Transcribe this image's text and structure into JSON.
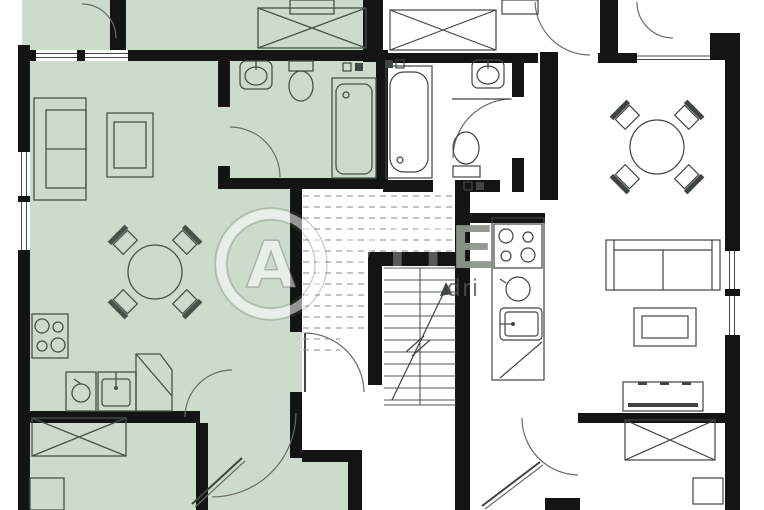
{
  "title": "two-unit apartment floor plan with central stairwell",
  "colors": {
    "wall": "#141414",
    "unit_left": "#cddbcc",
    "line": "#47524a",
    "dash": "#8a8a8a",
    "wm_gray": "#8e958d"
  },
  "watermark": {
    "logo_letter": "A",
    "letters_faint": "VIT",
    "letter_on_wall": "E",
    "small_text": "dri"
  },
  "plan": {
    "units": [
      {
        "id": "left-unit",
        "highlighted": true,
        "highlight_color": "#cddbcc",
        "rooms": [
          "bedroom-top",
          "living-dining-room",
          "kitchen",
          "bathroom",
          "hall",
          "storage-room"
        ],
        "fixtures": [
          "sofa",
          "tv-side-table",
          "round-dining-table-with-4-chairs",
          "stove-4-burners",
          "kitchen-sink",
          "under-counter-appliance",
          "corner-cabinet",
          "crossed-bed-top",
          "crossed-wardrobe-bottom",
          "washbasin",
          "toilet",
          "shower-tray",
          "small-cabinet"
        ]
      },
      {
        "id": "right-unit",
        "highlighted": false,
        "rooms": [
          "bedroom-top",
          "hallway",
          "bathroom",
          "kitchen",
          "dining-area",
          "living-room",
          "bedroom-bottom"
        ],
        "fixtures": [
          "bathtub",
          "washbasin",
          "toilet",
          "round-dining-table-with-4-chairs",
          "stove-4-burners",
          "kitchen-sink",
          "counter-appliance",
          "corner-cabinet",
          "sofa",
          "coffee-table",
          "desk-dresser",
          "crossed-bed-top",
          "crossed-bed-bottom",
          "nightstand"
        ]
      }
    ],
    "stairwell": {
      "features": [
        "dashed-upper-flight",
        "solid-lower-flight",
        "center-stringer",
        "direction-arrow-with-break",
        "entry-door-arc"
      ]
    },
    "openings": [
      "left-wall-window",
      "top-left-double-window",
      "top-right-window",
      "right-wall-window",
      "multiple-door-arcs",
      "two-diagonal-open-doors",
      "vent-marks-pairs"
    ]
  }
}
